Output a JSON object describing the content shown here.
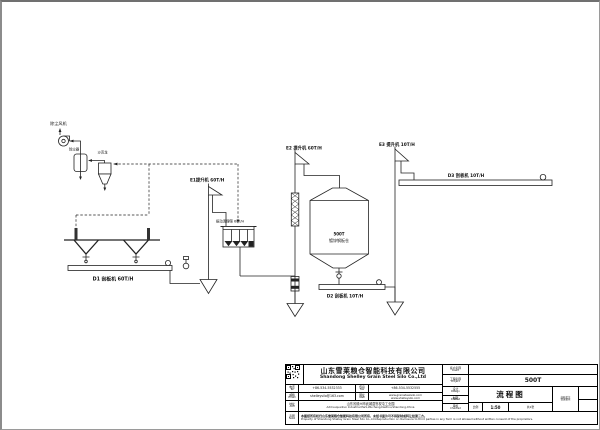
{
  "page": {
    "background": "#ffffff",
    "line_color": "#222222",
    "logo_color": "#7a1b20"
  },
  "diagram": {
    "labels": {
      "fan": "除尘风机",
      "filter": "除尘器",
      "cyclone": "沙克龙",
      "e1": "E1提升机 60T/H",
      "sieve": "振动清理筛 60T/H",
      "d1": "D1 刮板机 60T/H",
      "e2": "E2 提升机 60T/H",
      "silo_capacity": "500T",
      "silo_type": "镀锌钢板仓",
      "d2": "D2 刮板机 10T/H",
      "e3": "E3 提升机 10T/H",
      "d3": "D3 刮板机 10T/H"
    }
  },
  "titleblock": {
    "logo_letter": "S",
    "company_cn": "山东雪莱粮仓智能科技有限公司",
    "company_en": "Shandong Shelley Grain Steel Silo Co.,Ltd",
    "contact": {
      "tel_cn": "电话",
      "tel_en": "Tel",
      "tel_value": "+86-534-5532333",
      "fax_cn": "传真",
      "fax_en": "Fax",
      "fax_value": "+86-534-5532555",
      "email_cn": "邮箱",
      "email_en": "Email",
      "email_value": "shelleysilo@163.com",
      "web_cn": "网址",
      "web_en": "Web",
      "web_value1": "www.grainsteelsilo.com",
      "web_value2": "www.shelleysilo.com",
      "addr_cn": "地址",
      "addr_en": "Add",
      "addr_value_cn": "山东省德州市武城县鲁权屯工业园",
      "addr_value_en": "Add:Luquantun Industrial Park,Wucheng,Dezhou,Shandong,China"
    },
    "notice": {
      "label_cn": "声明",
      "label_en": "Note",
      "cn": "本图纸所有权归山东雪莱粮仓智能科技有限公司所有，未经书面许可不得复制或转让给第三方。",
      "en": "Property of Shandong Shelley Grain Steel Silo Co.,Ltd.Reproduction or disclosure to third parties in any form is not allowed without written consent of the proprietors."
    },
    "fields": {
      "client_cn": "客户名称",
      "client_en": "Client",
      "project_cn": "工程名称",
      "project_en": "Project",
      "project_value": "500T",
      "design_cn": "设计",
      "design_en": "Design",
      "draft_cn": "制图",
      "draft_en": "Drafted",
      "check_cn": "审核",
      "check_en": "Checked",
      "title_value": "流程图",
      "scale_label": "比例",
      "scale_value": "1:50",
      "sheet_label": "共1张",
      "qr_caption1": "扫码关注",
      "qr_caption2": "雪莱粮仓"
    }
  }
}
